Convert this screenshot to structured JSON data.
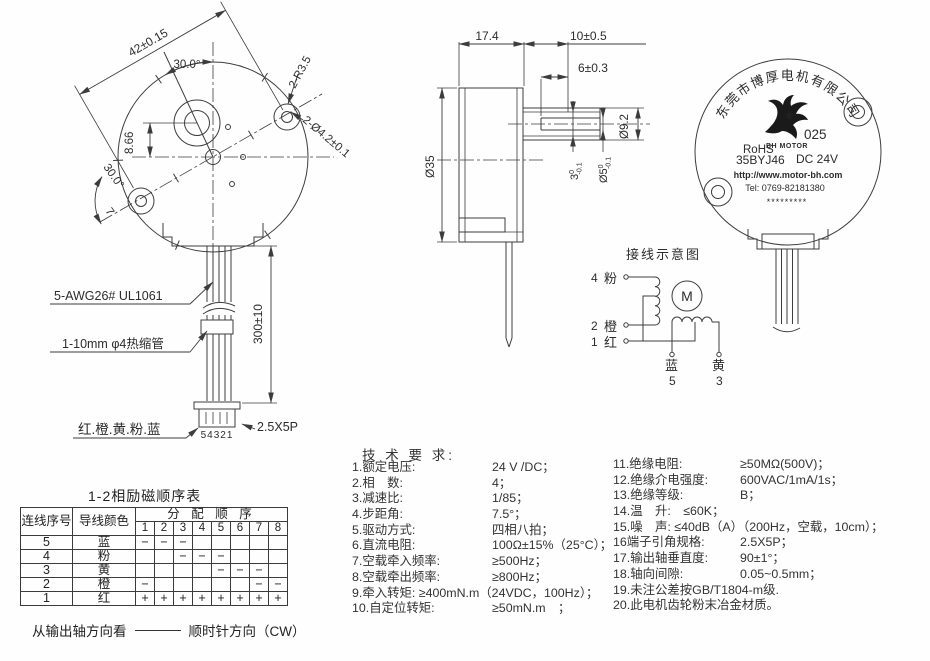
{
  "drawing": {
    "front_view": {
      "dim_42": "42±0.15",
      "dim_angle_top": "30.0°",
      "dim_866": "8.66",
      "dim_angle_left": "30.0°",
      "dim_7": "7",
      "dim_r": "2-R3.5",
      "dim_holes": "2-Ø4.2±0.1"
    },
    "leads": {
      "wire_spec": "5-AWG26# UL1061",
      "tube_spec": "1-10mm φ4热缩管",
      "colors": "红.橙.黄.粉.蓝",
      "pins": "54321",
      "connector": "2.5X5P",
      "length": "300±10"
    },
    "side_view": {
      "len_body": "17.4",
      "len_shaft": "10±0.5",
      "len_flat": "6±0.3",
      "dia_boss": "Ø9.2",
      "dia_body": "Ø35",
      "flat": {
        "v": "3",
        "tu": "0",
        "tl": "-0.1"
      },
      "shaft": {
        "v": "Ø5",
        "tu": "0",
        "tl": "-0.1"
      }
    },
    "label_view": {
      "company_arc": "东莞市博厚电机有限公司",
      "reg_mark": "®",
      "logo_code": "025",
      "logo_text": "BH MOTOR",
      "rohs": "RoHS",
      "model": "35BYJ46",
      "voltage": "DC 24V",
      "url": "http://www.motor-bh.com",
      "tel": "Tel: 0769-82181380",
      "stars": "*********"
    },
    "wiring": {
      "title": "接线示意图",
      "motor": "M",
      "n4": "4",
      "c4": "粉",
      "n2": "2",
      "c2": "橙",
      "n1": "1",
      "c1": "红",
      "c5": "蓝",
      "n5": "5",
      "c3": "黄",
      "n3": "3"
    }
  },
  "sequence_table": {
    "title": "1-2相励磁顺序表",
    "col_no": "连线序号",
    "col_color": "导线颜色",
    "col_seq": "分 配 顺 序",
    "steps": [
      "1",
      "2",
      "3",
      "4",
      "5",
      "6",
      "7",
      "8"
    ],
    "rows": [
      {
        "no": "5",
        "color": "蓝",
        "cells": [
          "−",
          "−",
          "−",
          "",
          "",
          "",
          "",
          ""
        ]
      },
      {
        "no": "4",
        "color": "粉",
        "cells": [
          "",
          "",
          "−",
          "−",
          "−",
          "",
          "",
          ""
        ]
      },
      {
        "no": "3",
        "color": "黄",
        "cells": [
          "",
          "",
          "",
          "",
          "−",
          "−",
          "−",
          ""
        ]
      },
      {
        "no": "2",
        "color": "橙",
        "cells": [
          "−",
          "",
          "",
          "",
          "",
          "",
          "−",
          "−"
        ]
      },
      {
        "no": "1",
        "color": "红",
        "cells": [
          "+",
          "+",
          "+",
          "+",
          "+",
          "+",
          "+",
          "+"
        ]
      }
    ],
    "note_left": "从输出轴方向看",
    "note_right": "顺时针方向（CW）"
  },
  "tech": {
    "title": "技 术 要 求:",
    "left": [
      {
        "label": "1.额定电压:",
        "value": "24 V /DC；"
      },
      {
        "label": "2.相　数:",
        "value": "4；"
      },
      {
        "label": "3.减速比:",
        "value": "1/85；"
      },
      {
        "label": "4.步距角:",
        "value": "7.5°；"
      },
      {
        "label": "5.驱动方式:",
        "value": "四相八拍；"
      },
      {
        "label": "6.直流电阻:",
        "value": "100Ω±15%（25°C）；"
      },
      {
        "label": "7.空载牵入频率:",
        "value": "≥500Hz；"
      },
      {
        "label": "8.空载牵出频率:",
        "value": "≥800Hz；"
      },
      {
        "label": "9.牵入转矩: ≥400mN.m（24VDC，100Hz）；",
        "value": ""
      },
      {
        "label": "10.自定位转矩:",
        "value": "≥50mN.m　；"
      }
    ],
    "right": [
      {
        "label": "11.绝缘电阻:",
        "value": "≥50MΩ(500V)；"
      },
      {
        "label": "12.绝缘介电强度:",
        "value": "600VAC/1mA/1s；"
      },
      {
        "label": "13.绝缘等级:",
        "value": "B；"
      },
      {
        "label": "14.温　升:　≤60K；",
        "value": ""
      },
      {
        "label": "15.噪　声: ≤40dB（A）（200Hz，空载，10cm）；",
        "value": ""
      },
      {
        "label": "16端子引角规格:",
        "value": "2.5X5P；"
      },
      {
        "label": "17.输出轴垂直度:",
        "value": "90±1°；"
      },
      {
        "label": "18.轴向间隙:",
        "value": "0.05~0.5mm；"
      },
      {
        "label": "19.未注公差按GB/T1804-m级.",
        "value": ""
      },
      {
        "label": "20.此电机齿轮粉末冶金材质。",
        "value": ""
      }
    ]
  }
}
